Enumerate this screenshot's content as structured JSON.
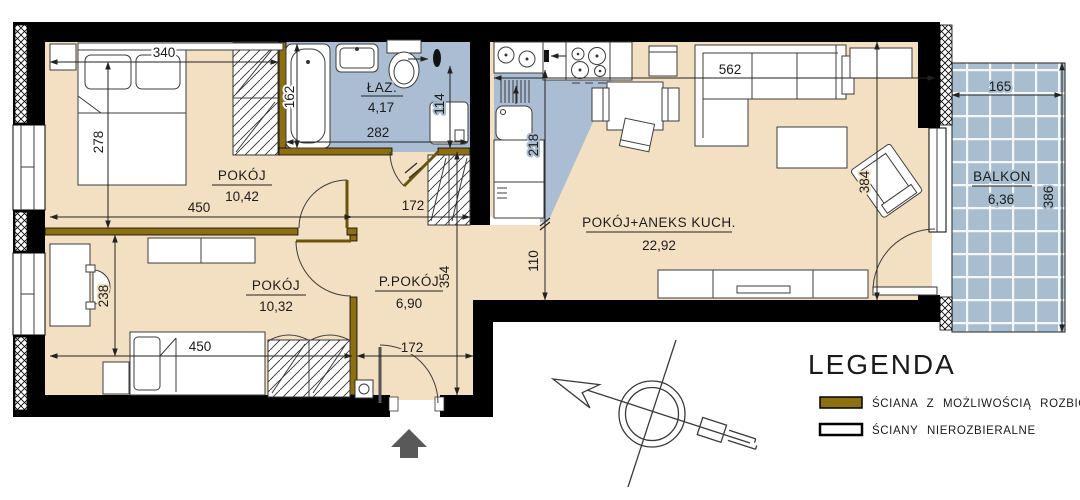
{
  "title": "apartment-floor-plan",
  "rooms": {
    "bedroom1": {
      "name": "POKÓJ",
      "area": "10,42"
    },
    "bedroom2": {
      "name": "POKÓJ",
      "area": "10,32"
    },
    "hall": {
      "name": "P.POKÓJ",
      "area": "6,90"
    },
    "bathroom": {
      "name": "ŁAZ.",
      "area": "4,17"
    },
    "living": {
      "name": "POKÓJ+ANEKS KUCH.",
      "area": "22,92"
    },
    "balcony": {
      "name": "BALKON",
      "area": "6,36"
    }
  },
  "dims": {
    "d340": "340",
    "d278": "278",
    "d450_top": "450",
    "d172_top": "172",
    "d162": "162",
    "d282": "282",
    "d114": "114",
    "d218": "218",
    "d110": "110",
    "d354": "354",
    "d450_bottom": "450",
    "d238": "238",
    "d172_bottom": "172",
    "d562": "562",
    "d384": "384",
    "d165": "165",
    "d386": "386"
  },
  "legend": {
    "title": "LEGENDA",
    "items": [
      {
        "label": "ŚCIANA Z MOŻLIWOŚCIĄ ROZBIÓRKI",
        "type": "demolishable-wall"
      },
      {
        "label": "ŚCIANY NIEROZBIERALNE",
        "type": "non-demolishable-wall"
      }
    ]
  },
  "colors": {
    "floor": "#f3e0c2",
    "wet_zone": "#aabdd3",
    "balcony_tile": "#a9bdd1",
    "demolishable_wall": "#8d6e10",
    "wall": "#000000",
    "entry_arrow": "#595959"
  }
}
